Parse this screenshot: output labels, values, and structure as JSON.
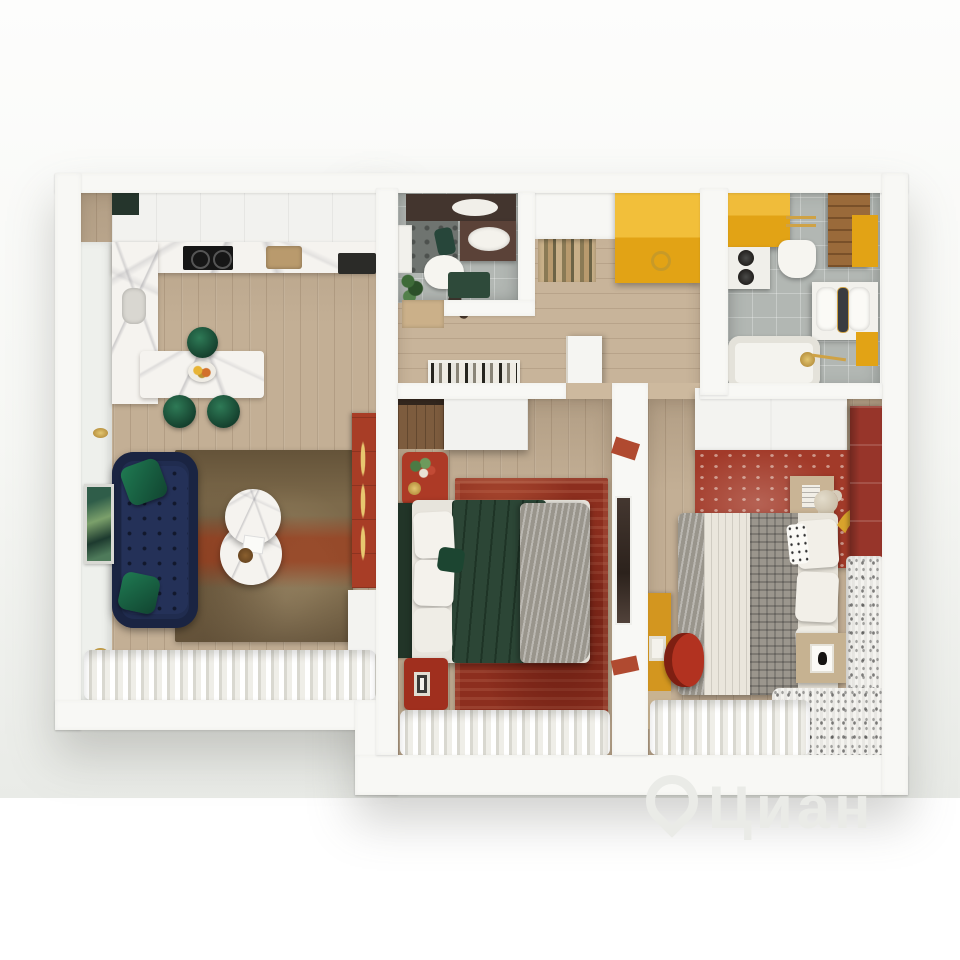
{
  "meta": {
    "type": "3d-floor-plan-render",
    "description": "Top-down 3D render of a two-bedroom apartment with kitchen-living room, hallway, two bathrooms and two bedrooms"
  },
  "watermark": {
    "text": "Циан",
    "icon": "location-pin-icon",
    "color": "#eaebe7"
  },
  "palette": {
    "backdrop": "#edefeb",
    "wall": "#f8f8f5",
    "wood_floor": "#c3af95",
    "tile_floor": "#b2b7b3",
    "marble": "#f5f3ef",
    "navy_sofa": "#202c4f",
    "emerald": "#1d5b42",
    "mustard": "#e2a315",
    "red_accent": "#a93a28",
    "rug_brown": "#7d6a4b",
    "rug_red": "#8e2f1f",
    "duvet_green": "#2c4636",
    "curtain_white": "#f2f1ec",
    "wood_cabinet": "#7d5c3e"
  },
  "rooms": [
    {
      "id": "kitchen-living",
      "furniture": [
        "white-upper-cabinets",
        "marble-countertop",
        "induction-cooktop",
        "cooker-hood",
        "marble-side-counter",
        "marble-breakfast-bar",
        "fruit-bowl",
        "green-velvet-stools-x3",
        "navy-chesterfield-sofa",
        "emerald-pillows-x2",
        "round-marble-coffee-tables-x2",
        "distressed-brown-rug",
        "green-wall-art",
        "gold-sconces-x2",
        "red-sideboard",
        "white-column-cabinet",
        "sheer-curtains"
      ]
    },
    {
      "id": "hallway",
      "furniture": [
        "entrance-door",
        "striped-doormat",
        "mustard-wardrobe",
        "shoes",
        "white-pouf",
        "gallery-frame",
        "open-bedroom-door"
      ]
    },
    {
      "id": "guest-bathroom",
      "furniture": [
        "dark-vanity-with-sink",
        "mirror",
        "toilet",
        "green-bath-mat",
        "plant",
        "shower-corner",
        "switch-panel"
      ]
    },
    {
      "id": "main-bathroom",
      "furniture": [
        "mustard-upper-cabinet",
        "stacked-washer-dryer",
        "wooden-tall-cabinet",
        "gold-towel-ladder",
        "wall-hung-toilet",
        "double-basin-vanity",
        "mustard-base-cabinet",
        "bathtub-with-gold-fittings"
      ]
    },
    {
      "id": "bedroom-1",
      "furniture": [
        "wood-desk",
        "white-wardrobe",
        "red-console-with-flowers",
        "green-headboard-bed",
        "white-pillows",
        "green-velvet-duvet",
        "gray-knit-throw",
        "red-oriental-rug",
        "red-nightstand",
        "sheer-curtains",
        "full-length-mirror-on-divider"
      ]
    },
    {
      "id": "bedroom-2",
      "furniture": [
        "white-wardrobe",
        "brick-red-rug",
        "storage-cube",
        "teddy-bear",
        "bed-with-plaid-throw",
        "yellow-curved-headboard",
        "red-paneled-accent-wall",
        "mustard-desk",
        "red-tulip-chair",
        "nightstand-with-figurine",
        "patterned-sheer-curtain",
        "sheer-curtains"
      ]
    }
  ]
}
